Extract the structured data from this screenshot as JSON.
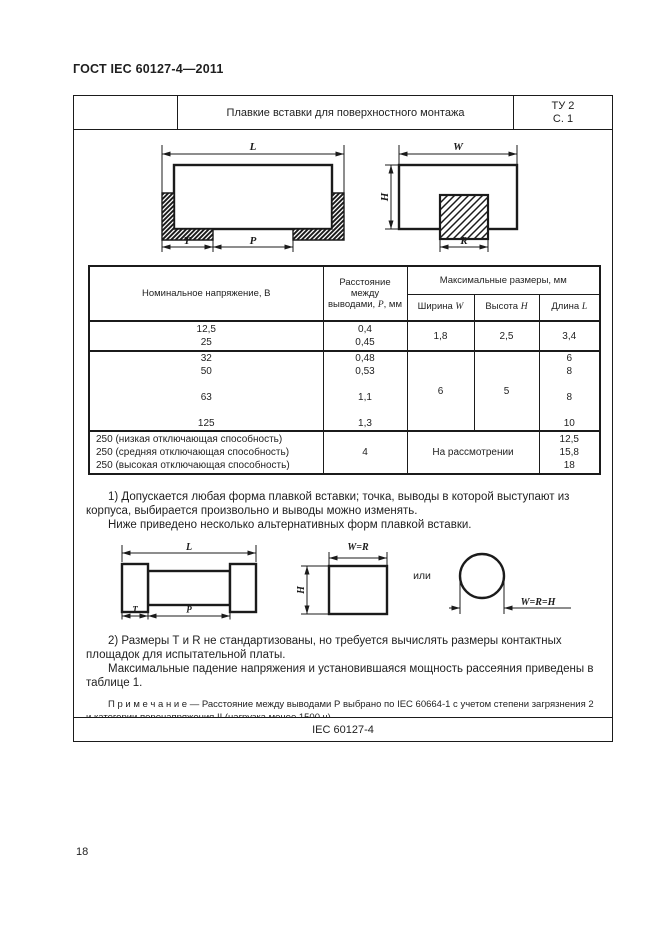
{
  "page": {
    "header": "ГОСТ IEC 60127-4—2011",
    "page_number": "18",
    "footer_doc": "IEC 60127-4"
  },
  "title_block": {
    "title": "Плавкие вставки для поверхностного монтажа",
    "type_ref": "ТУ 2",
    "sheet_ref": "С. 1"
  },
  "figures": {
    "front_view": {
      "length": "L",
      "terminal": "T",
      "pitch": "P"
    },
    "side_view": {
      "width": "W",
      "height": "H",
      "terminal_width": "R"
    },
    "alt_front": {
      "length": "L",
      "terminal": "T",
      "pitch": "P"
    },
    "alt_side": {
      "top": "W=R",
      "height": "H"
    },
    "or": "или",
    "alt_round": {
      "dim": "W=R=H"
    }
  },
  "table": {
    "col_voltage": "Номинальное напряжение, В",
    "col_pitch_prefix": "Расстояние между выводами, ",
    "col_pitch_symbol": "P",
    "col_pitch_suffix": ", мм",
    "col_max": "Максимальные размеры, мм",
    "col_w_label": "Ширина ",
    "col_w_symbol": "W",
    "col_h_label": "Высота ",
    "col_h_symbol": "H",
    "col_l_label": "Длина ",
    "col_l_symbol": "L",
    "rows": [
      {
        "voltage": [
          "12,5",
          "25"
        ],
        "pitch": [
          "0,4",
          "0,45"
        ],
        "w": "1,8",
        "h": "2,5",
        "length": [
          "3,4"
        ]
      },
      {
        "voltage": [
          "32",
          "50",
          "",
          "63",
          "",
          "125"
        ],
        "pitch": [
          "0,48",
          "0,53",
          "",
          "1,1",
          "",
          "1,3"
        ],
        "w": "6",
        "h": "5",
        "length": [
          "6",
          "8",
          "",
          "8",
          "",
          "10"
        ]
      },
      {
        "voltage": [
          "250 (низкая отключающая способность)",
          "250 (средняя отключающая способность)",
          "250 (высокая отключающая способность)"
        ],
        "pitch": [
          "4"
        ],
        "wh": "На рассмотрении",
        "length": [
          "12,5",
          "15,8",
          "18"
        ]
      }
    ]
  },
  "notes": {
    "para1": "1) Допускается любая форма плавкой вставки; точка, выводы в которой выступают из корпуса, выбирается произвольно и выводы можно изменять.",
    "para1b": "Ниже приведено несколько альтернативных форм плавкой вставки.",
    "para2": "2) Размеры Т и R не стандартизованы, но требуется вычислять размеры контактных площадок для испытательной платы.",
    "para2b": "Максимальные падение напряжения и установившаяся мощность рассеяния приведены в таблице 1.",
    "note": "П р и м е ч а н и е — Расстояние между выводами Р выбрано по IEC 60664-1 с учетом степени загрязнения 2 и категории перенапряжения II (нагрузка менее 1500 ч)."
  }
}
